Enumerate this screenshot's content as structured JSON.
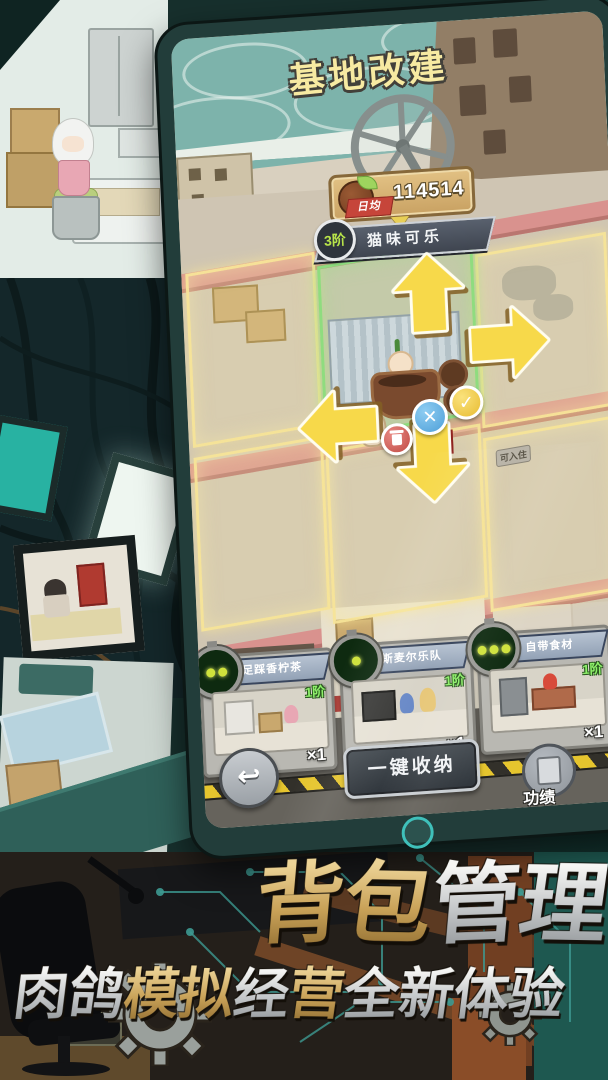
{
  "game_screen": {
    "title": "基地改建",
    "income": {
      "label": "日均",
      "value": "114514"
    },
    "selected": {
      "tier": "3阶",
      "name": "猫味可乐"
    },
    "room_sign": "可入住",
    "icons": {
      "confirm": "✓",
      "cancel": "✕",
      "back": "↩"
    },
    "cards": [
      {
        "name": "足踩香柠茶",
        "tier": "1阶",
        "count": "×1",
        "signal_dots": 2
      },
      {
        "name": "斯麦尔乐队",
        "tier": "1阶",
        "count": "×1",
        "signal_dots": 1
      },
      {
        "name": "自带食材",
        "tier": "1阶",
        "count": "×1",
        "signal_dots": 3
      }
    ],
    "footer": {
      "collect_all": "一键收纳",
      "achievement": "功绩"
    }
  },
  "promo": {
    "headline": [
      {
        "ch": "背",
        "tone": "gold"
      },
      {
        "ch": "包",
        "tone": "gold"
      },
      {
        "ch": "管",
        "tone": "silver"
      },
      {
        "ch": "理",
        "tone": "silver"
      }
    ],
    "subline": [
      {
        "ch": "肉",
        "tone": "silver"
      },
      {
        "ch": "鸽",
        "tone": "silver"
      },
      {
        "ch": "模",
        "tone": "gold"
      },
      {
        "ch": "拟",
        "tone": "gold"
      },
      {
        "ch": "经",
        "tone": "silver"
      },
      {
        "ch": "营",
        "tone": "gold"
      },
      {
        "ch": "全",
        "tone": "silver"
      },
      {
        "ch": "新",
        "tone": "silver"
      },
      {
        "ch": "体",
        "tone": "silver"
      },
      {
        "ch": "验",
        "tone": "silver"
      }
    ]
  },
  "colors": {
    "accent_teal": "#3fc0ba",
    "arrow_yellow": "#f7d94a",
    "confirm_yellow": "#e8bc32",
    "cancel_blue": "#4e9fd8",
    "delete_red": "#c04a44",
    "tier_green": "#8ef06a",
    "hazard_yellow": "#e6c52e"
  }
}
